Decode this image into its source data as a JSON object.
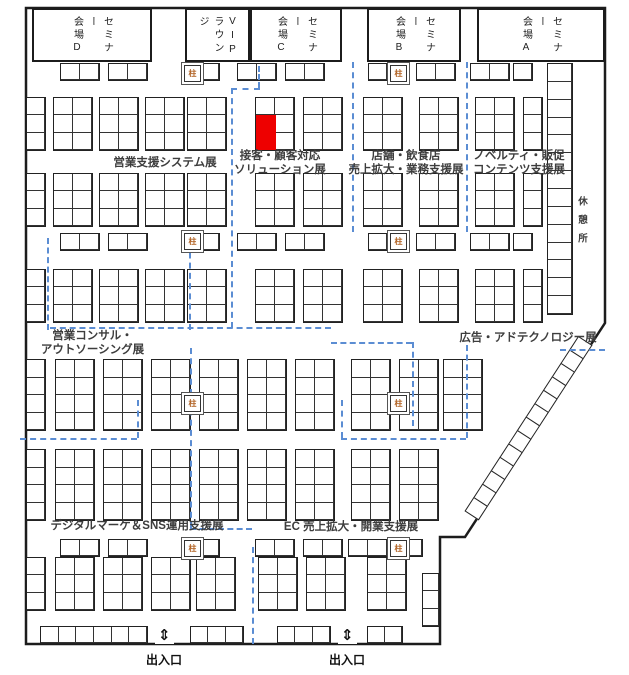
{
  "map": {
    "rooms": [
      {
        "id": "hall-d",
        "line1": "セミナー",
        "line2": "会場D"
      },
      {
        "id": "vip",
        "line1": "VIP",
        "line2": "ラウンジ"
      },
      {
        "id": "hall-c",
        "line1": "セミナー",
        "line2": "会場C"
      },
      {
        "id": "hall-b",
        "line1": "セミナー",
        "line2": "会場B"
      },
      {
        "id": "hall-a",
        "line1": "セミナー",
        "line2": "会場A"
      }
    ],
    "zones": {
      "z1": {
        "lines": [
          "営業支援システム展"
        ]
      },
      "z2": {
        "lines": [
          "接客・顧客対応",
          "ソリューション展"
        ]
      },
      "z3": {
        "lines": [
          "店舗・飲食店",
          "売上拡大・業務支援展"
        ]
      },
      "z4": {
        "lines": [
          "ノベルティ・販促",
          "コンテンツ支援展"
        ]
      },
      "z5": {
        "lines": [
          "営業コンサル・",
          "アウトソーシング展"
        ]
      },
      "z6": {
        "lines": [
          "広告・アドテクノロジー展"
        ]
      },
      "z7": {
        "lines": [
          "デジタルマーケ＆SNS運用支援展"
        ]
      },
      "z8": {
        "lines": [
          "EC 売上拡大・開業支援展"
        ]
      }
    },
    "rest_area": "休憩所",
    "pillar_label": "柱",
    "exit_label": "出入口",
    "exit_arrow": "⇕",
    "colors": {
      "highlight": "#ee0000",
      "boundary": "#5b8dd3",
      "wall": "#1c1c1c"
    },
    "red_booth": {
      "x": 256,
      "y": 115,
      "w": 20,
      "h": 35
    },
    "booths": [
      [
        60,
        63,
        2,
        1
      ],
      [
        108,
        63,
        2,
        1
      ],
      [
        200,
        63,
        1,
        1
      ],
      [
        237,
        63,
        2,
        1
      ],
      [
        285,
        63,
        2,
        1
      ],
      [
        368,
        63,
        1,
        1
      ],
      [
        416,
        63,
        2,
        1
      ],
      [
        470,
        63,
        2,
        1
      ],
      [
        513,
        63,
        1,
        1
      ],
      [
        53,
        97,
        2,
        3
      ],
      [
        99,
        97,
        2,
        3
      ],
      [
        145,
        97,
        2,
        3
      ],
      [
        187,
        97,
        2,
        3
      ],
      [
        255,
        97,
        2,
        3
      ],
      [
        303,
        97,
        2,
        3
      ],
      [
        363,
        97,
        2,
        3
      ],
      [
        419,
        97,
        2,
        3
      ],
      [
        475,
        97,
        2,
        3
      ],
      [
        523,
        97,
        1,
        3
      ],
      [
        53,
        173,
        2,
        3
      ],
      [
        99,
        173,
        2,
        3
      ],
      [
        145,
        173,
        2,
        3
      ],
      [
        187,
        173,
        2,
        3
      ],
      [
        255,
        173,
        2,
        3
      ],
      [
        303,
        173,
        2,
        3
      ],
      [
        363,
        173,
        2,
        3
      ],
      [
        419,
        173,
        2,
        3
      ],
      [
        475,
        173,
        2,
        3
      ],
      [
        523,
        173,
        1,
        3
      ],
      [
        60,
        233,
        2,
        1
      ],
      [
        108,
        233,
        2,
        1
      ],
      [
        200,
        233,
        1,
        1
      ],
      [
        237,
        233,
        2,
        1
      ],
      [
        285,
        233,
        2,
        1
      ],
      [
        368,
        233,
        1,
        1
      ],
      [
        416,
        233,
        2,
        1
      ],
      [
        470,
        233,
        2,
        1
      ],
      [
        513,
        233,
        1,
        1
      ],
      [
        53,
        269,
        2,
        3
      ],
      [
        99,
        269,
        2,
        3
      ],
      [
        145,
        269,
        2,
        3
      ],
      [
        187,
        269,
        2,
        3
      ],
      [
        255,
        269,
        2,
        3
      ],
      [
        303,
        269,
        2,
        3
      ],
      [
        363,
        269,
        2,
        3
      ],
      [
        419,
        269,
        2,
        3
      ],
      [
        475,
        269,
        2,
        3
      ],
      [
        523,
        269,
        1,
        3
      ],
      [
        55,
        359,
        2,
        4
      ],
      [
        103,
        359,
        2,
        4
      ],
      [
        151,
        359,
        2,
        4
      ],
      [
        199,
        359,
        2,
        4
      ],
      [
        247,
        359,
        2,
        4
      ],
      [
        295,
        359,
        2,
        4
      ],
      [
        351,
        359,
        2,
        4
      ],
      [
        399,
        359,
        2,
        4
      ],
      [
        443,
        359,
        2,
        4
      ],
      [
        55,
        449,
        2,
        4
      ],
      [
        103,
        449,
        2,
        4
      ],
      [
        151,
        449,
        2,
        4
      ],
      [
        199,
        449,
        2,
        4
      ],
      [
        247,
        449,
        2,
        4
      ],
      [
        295,
        449,
        2,
        4
      ],
      [
        351,
        449,
        2,
        4
      ],
      [
        399,
        449,
        2,
        4
      ],
      [
        60,
        539,
        2,
        1
      ],
      [
        108,
        539,
        2,
        1
      ],
      [
        200,
        539,
        1,
        1
      ],
      [
        255,
        539,
        2,
        1
      ],
      [
        303,
        539,
        2,
        1
      ],
      [
        348,
        539,
        2,
        1
      ],
      [
        403,
        539,
        1,
        1
      ],
      [
        55,
        557,
        2,
        3
      ],
      [
        103,
        557,
        2,
        3
      ],
      [
        151,
        557,
        2,
        3
      ],
      [
        196,
        557,
        2,
        3
      ],
      [
        258,
        557,
        2,
        3
      ],
      [
        306,
        557,
        2,
        3
      ],
      [
        367,
        557,
        2,
        3
      ],
      [
        26,
        97,
        1,
        3
      ],
      [
        26,
        173,
        1,
        3
      ],
      [
        26,
        269,
        1,
        3
      ],
      [
        26,
        359,
        1,
        4
      ],
      [
        26,
        449,
        1,
        4
      ],
      [
        26,
        557,
        1,
        3
      ],
      [
        547,
        63,
        1,
        14,
        26
      ],
      [
        422,
        573,
        1,
        3,
        18
      ],
      [
        40,
        626,
        6,
        1,
        18
      ],
      [
        190,
        626,
        3,
        1,
        18
      ],
      [
        277,
        626,
        3,
        1,
        18
      ],
      [
        367,
        626,
        2,
        1,
        18
      ]
    ],
    "pillars": [
      {
        "x": 184,
        "y": 65
      },
      {
        "x": 390,
        "y": 65
      },
      {
        "x": 184,
        "y": 233
      },
      {
        "x": 390,
        "y": 233
      },
      {
        "x": 184,
        "y": 395
      },
      {
        "x": 390,
        "y": 395
      },
      {
        "x": 184,
        "y": 540
      },
      {
        "x": 390,
        "y": 540
      }
    ],
    "boundaries": [
      [
        "v",
        258,
        66,
        22
      ],
      [
        "h",
        231,
        88,
        29
      ],
      [
        "v",
        231,
        88,
        240
      ],
      [
        "v",
        352,
        62,
        170
      ],
      [
        "v",
        466,
        62,
        170
      ],
      [
        "v",
        189,
        232,
        98
      ],
      [
        "v",
        47,
        238,
        92
      ],
      [
        "h",
        50,
        327,
        281
      ],
      [
        "h",
        331,
        342,
        81
      ],
      [
        "v",
        412,
        342,
        84
      ],
      [
        "h",
        560,
        349,
        45
      ],
      [
        "v",
        466,
        345,
        93
      ],
      [
        "h",
        341,
        438,
        125
      ],
      [
        "v",
        341,
        400,
        38
      ],
      [
        "h",
        20,
        438,
        117
      ],
      [
        "v",
        137,
        400,
        38
      ],
      [
        "v",
        190,
        348,
        180
      ],
      [
        "h",
        190,
        528,
        62
      ],
      [
        "v",
        252,
        547,
        97
      ]
    ],
    "diagonal_strip": {
      "count": 13,
      "x": 592,
      "y": 346,
      "angle": 123
    }
  }
}
